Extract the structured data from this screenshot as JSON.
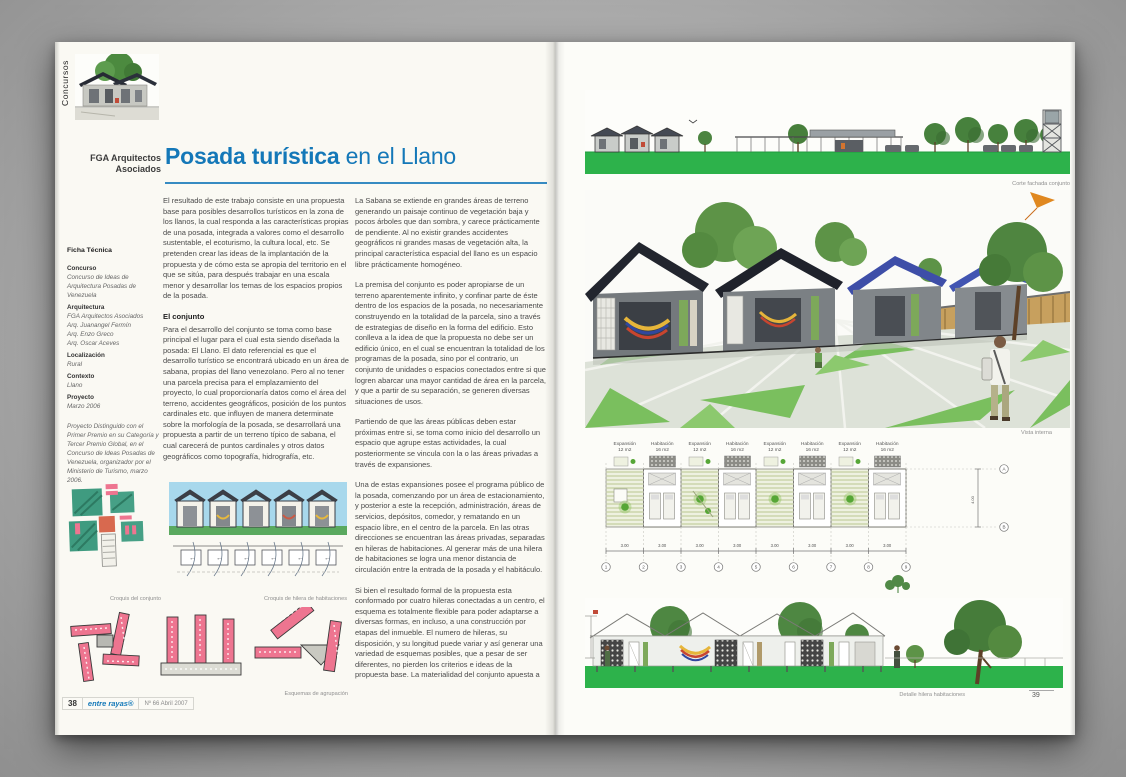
{
  "palette": {
    "title_blue": "#1478b8",
    "grass_green": "#2db24b",
    "plaza_green": "#7abf5e",
    "sketch_pink": "#ee7590",
    "sketch_teal": "#3f9b80",
    "sky_blue": "#a8d8ec"
  },
  "left_page": {
    "section_tab": "Concursos",
    "byline": {
      "line1": "FGA Arquitectos",
      "line2": "Asociados"
    },
    "title": {
      "strong": "Posada turística",
      "rest": " en el Llano"
    },
    "ficha": {
      "heading": "Ficha Técnica",
      "concurso_label": "Concurso",
      "concurso_value": "Concurso de Ideas de Arquitectura Posadas de Venezuela",
      "arquitectura_label": "Arquitectura",
      "arquitectura_line1": "FGA Arquitectos Asociados",
      "arquitectura_line2": "Arq. Juanangel Fermín",
      "arquitectura_line3": "Arq. Enzo Greco",
      "arquitectura_line4": "Arq. Oscar Aceves",
      "localizacion_label": "Localización",
      "localizacion_value": "Rural",
      "contexto_label": "Contexto",
      "contexto_value": "Llano",
      "proyecto_label": "Proyecto",
      "proyecto_value": "Marzo 2006",
      "award_note": "Proyecto Distinguido con el Primer Premio en su Categoría y Tercer Premio Global, en el Concurso de Ideas Posadas de Venezuela, organizador por el Ministerio de Turismo, marzo 2006."
    },
    "article": {
      "col1_p1": "El resultado de este trabajo consiste en una propuesta base para posibles desarrollos turísticos en la zona de los llanos, la cual responda a las características propias de una posada, integrada a valores como el desarrollo sustentable, el ecoturismo, la cultura local, etc. Se pretenden crear las ideas de la implantación de la propuesta y de cómo esta se apropia del territorio en el que se sitúa, para después trabajar en una escala menor y desarrollar los temas de los espacios propios de la posada.",
      "col1_heading": "El conjunto",
      "col1_p2": "Para el desarrollo del conjunto se toma como base principal el lugar para el cual esta siendo diseñada la posada: El Llano. El dato referencial es que el desarrollo turístico se encontrará ubicado en un área de sabana, propias del llano venezolano. Pero al no tener una parcela precisa para el emplazamiento del proyecto, lo cual proporcionaría datos como el área del terreno, accidentes geográficos, posición de los puntos cardinales etc. que influyen de manera determinate sobre la morfología de la posada, se desarrollará una propuesta a partir de un terreno típico de sabana, el cual carecerá de puntos cardinales y otros datos geográficos como topografía, hidrografía, etc.",
      "col2_p1": "La Sabana se extiende en grandes áreas de terreno generando un paisaje continuo de vegetación baja y pocos árboles que dan sombra, y carece prácticamente de pendiente. Al no existir grandes accidentes geográficos ni grandes masas de vegetación alta, la principal característica espacial del llano es un espacio libre prácticamente homogéneo.",
      "col2_p2": "La premisa del conjunto es poder apropiarse de un terreno aparentemente infinito, y confinar parte de éste dentro de los espacios de la posada, no necesariamente construyendo en la totalidad de la parcela, sino a través de estrategias de diseño en la forma del edificio. Esto conlleva a la idea de que la propuesta no debe ser un edificio único, en el cual se encuentran la totalidad de los programas de la posada, sino por el contrario, un conjunto de unidades o espacios conectados entre si que logren abarcar una mayor cantidad de área en la parcela, y que a partir de su separación, se generen diversas situaciones de usos.",
      "col2_p3": "Partiendo de que las áreas públicas deben estar próximas entre si, se toma como inicio del desarrollo un espacio que agrupe estas actividades, la cual posteriormente se vincula con la o las áreas privadas a través de expansiones.",
      "col2_p4": "Una de estas expansiones posee el programa público de la posada, comenzando por un área de estacionamiento, y posterior a este la recepción, administración, áreas de servicios, depósitos, comedor, y rematando en un espacio libre, en el centro de la parcela. En las otras direcciones se encuentran las áreas privadas, separadas en hileras de habitaciones. Al generar más de una hilera de habitaciones se logra una menor distancia de circulación entre la entrada de la posada y el habitáculo.",
      "col2_p5": "Si bien el resultado formal de la propuesta esta conformado por cuatro hileras conectadas a un centro, el esquema es totalmente flexible para poder adaptarse a diversas formas, en incluso, a una construcción por etapas del inmueble. El numero de hileras, su disposición, y su longitud puede variar y así generar una variedad de esquemas posibles, que a pesar de ser diferentes, no pierden los criterios e ideas de la propuesta base. La materialidad del conjunto apuesta a"
    },
    "captions": {
      "croquis_conjunto": "Croquis del conjunto",
      "croquis_hilera": "Croquis de hilera de habitaciones",
      "esquemas": "Esquemas de agrupación"
    },
    "footer": {
      "page_number": "38",
      "magazine": "entre rayas®",
      "issue": "Nº 66 Abril 2007"
    }
  },
  "right_page": {
    "captions": {
      "top": "Corte fachada conjunto",
      "middle": "Vista interna",
      "bottom": "Detalle hilera habitaciones"
    },
    "plan": {
      "labels": [
        {
          "name": "Expansión",
          "area": "12 m2"
        },
        {
          "name": "Habitación",
          "area": "16 m2"
        },
        {
          "name": "Expansión",
          "area": "12 m2"
        },
        {
          "name": "Habitación",
          "area": "16 m2"
        },
        {
          "name": "Expansión",
          "area": "12 m2"
        },
        {
          "name": "Habitación",
          "area": "16 m2"
        },
        {
          "name": "Expansión",
          "area": "12 m2"
        },
        {
          "name": "Habitación",
          "area": "16 m2"
        }
      ],
      "bay_dim": "3.00",
      "row_dim": "4.00",
      "grid": [
        "1",
        "2",
        "3",
        "4",
        "5",
        "6",
        "7",
        "8",
        "9"
      ],
      "row_letters": [
        "A",
        "B"
      ]
    },
    "page_number": "39"
  }
}
